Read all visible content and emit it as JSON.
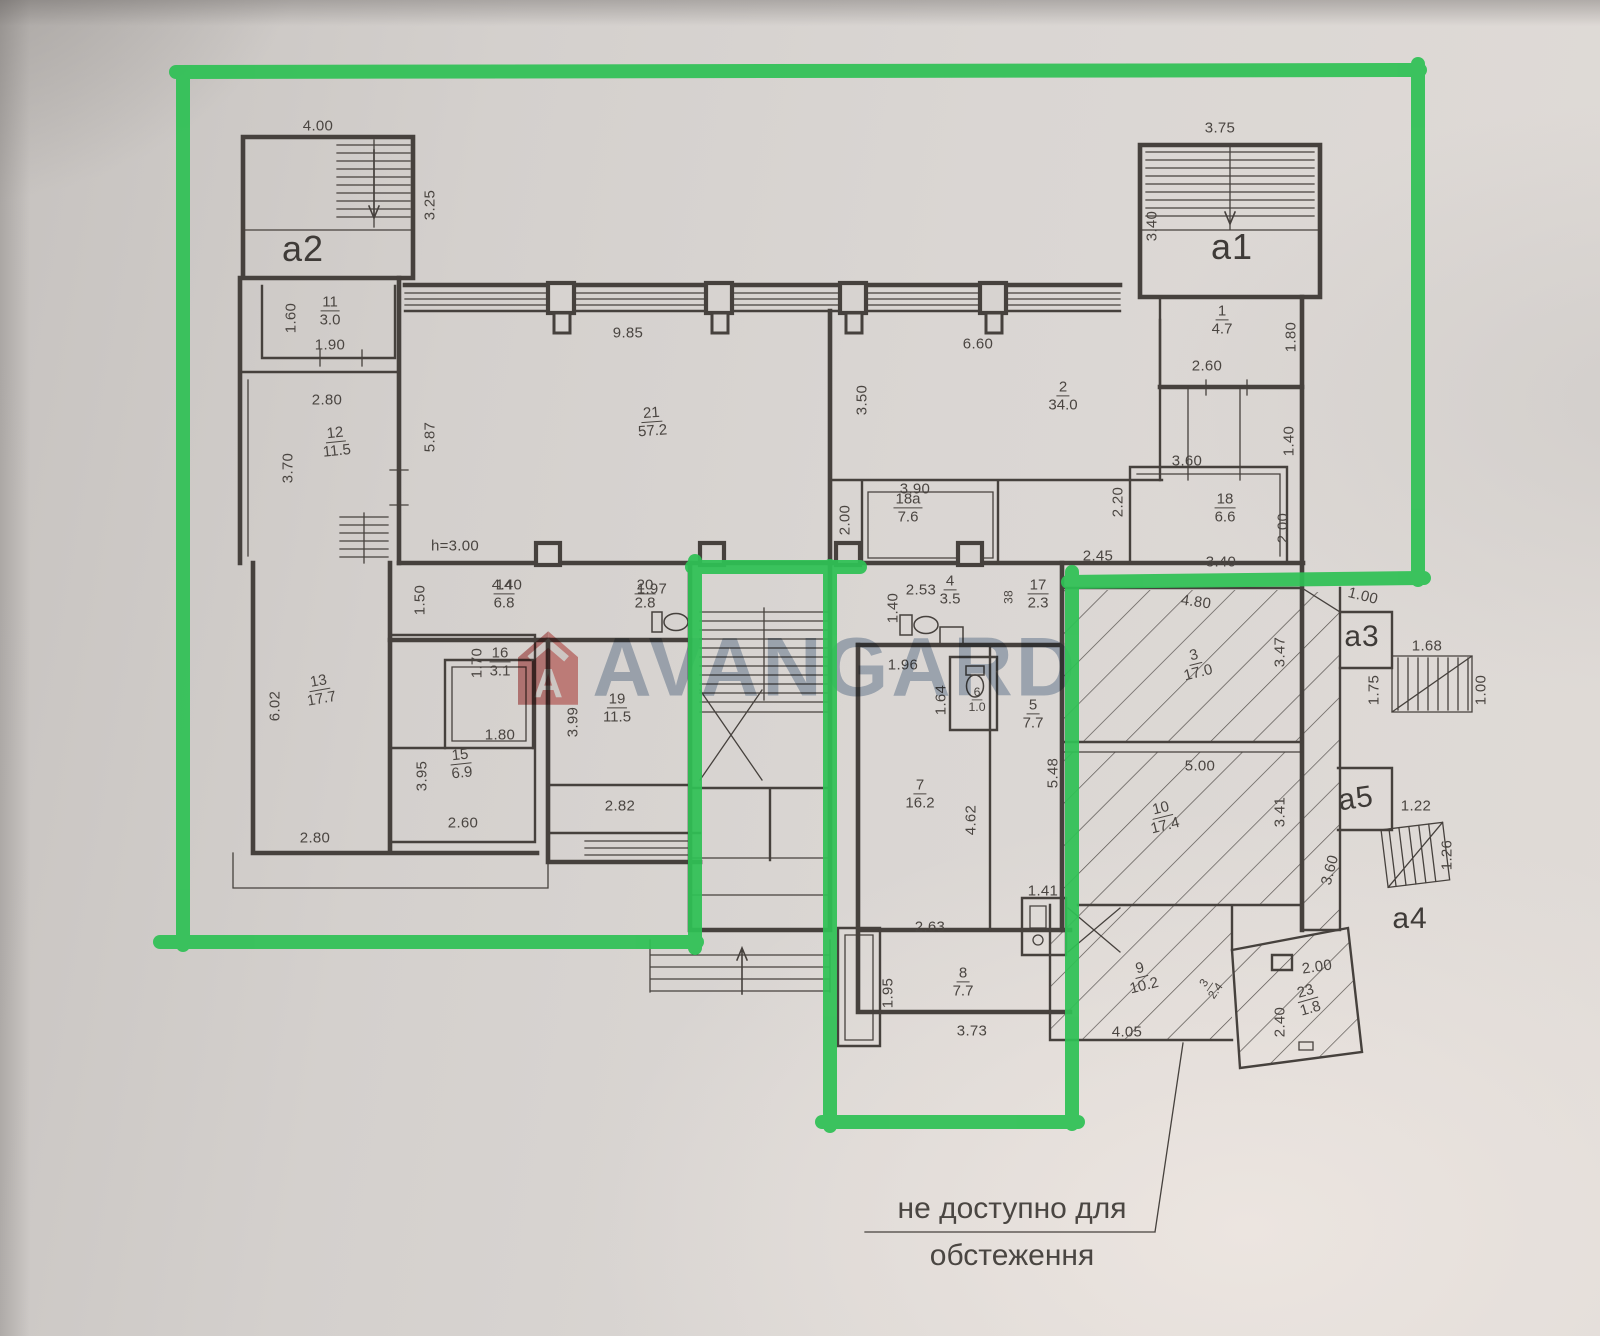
{
  "colors": {
    "annotation_green": "#2fc155",
    "paper": "#d8d4d1",
    "ink": "#44403c",
    "watermark_blue": "#64809f",
    "watermark_red": "#c8504e"
  },
  "watermark": {
    "brand": "AVANGARD",
    "logo_letter": "A"
  },
  "note": {
    "line1": "не доступно для",
    "line2": "обстеження"
  },
  "plan": {
    "block_labels": [
      {
        "text": "a2",
        "x": 303,
        "y": 249,
        "size": 36
      },
      {
        "text": "a1",
        "x": 1232,
        "y": 247,
        "size": 36
      },
      {
        "text": "a3",
        "x": 1362,
        "y": 637,
        "size": 30
      },
      {
        "text": "a5",
        "x": 1356,
        "y": 799,
        "size": 30,
        "rot": -8
      },
      {
        "text": "a4",
        "x": 1410,
        "y": 919,
        "size": 30
      }
    ],
    "room_labels": [
      {
        "num": "11",
        "area": "3.0",
        "x": 330,
        "y": 311
      },
      {
        "num": "12",
        "area": "11.5",
        "x": 336,
        "y": 442,
        "rot": -6
      },
      {
        "num": "21",
        "area": "57.2",
        "x": 652,
        "y": 422,
        "rot": -4
      },
      {
        "num": "2",
        "area": "34.0",
        "x": 1063,
        "y": 396
      },
      {
        "num": "1",
        "area": "4.7",
        "x": 1222,
        "y": 320
      },
      {
        "num": "18a",
        "area": "7.6",
        "x": 908,
        "y": 508
      },
      {
        "num": "18",
        "area": "6.6",
        "x": 1225,
        "y": 508
      },
      {
        "num": "14",
        "area": "6.8",
        "x": 504,
        "y": 594
      },
      {
        "num": "20",
        "area": "2.8",
        "x": 645,
        "y": 594
      },
      {
        "num": "4",
        "area": "3.5",
        "x": 950,
        "y": 590
      },
      {
        "num": "17",
        "area": "2.3",
        "x": 1038,
        "y": 594
      },
      {
        "num": "13",
        "area": "17.7",
        "x": 320,
        "y": 690,
        "rot": -10
      },
      {
        "num": "16",
        "area": "3.1",
        "x": 500,
        "y": 662
      },
      {
        "num": "15",
        "area": "6.9",
        "x": 461,
        "y": 764,
        "rot": -6
      },
      {
        "num": "19",
        "area": "11.5",
        "x": 617,
        "y": 708
      },
      {
        "num": "6",
        "area": "1.0",
        "x": 977,
        "y": 700,
        "scale": 0.82
      },
      {
        "num": "5",
        "area": "7.7",
        "x": 1033,
        "y": 714
      },
      {
        "num": "3",
        "area": "17.0",
        "x": 1196,
        "y": 664,
        "rot": -14
      },
      {
        "num": "7",
        "area": "16.2",
        "x": 920,
        "y": 794
      },
      {
        "num": "10",
        "area": "17.4",
        "x": 1163,
        "y": 817,
        "rot": -14
      },
      {
        "num": "8",
        "area": "7.7",
        "x": 963,
        "y": 982
      },
      {
        "num": "9",
        "area": "10.2",
        "x": 1142,
        "y": 977,
        "rot": -14
      },
      {
        "num": "23",
        "area": "1.8",
        "x": 1308,
        "y": 1000,
        "rot": -16
      },
      {
        "num": "3",
        "area": "2.4",
        "x": 1210,
        "y": 987,
        "rot": -55,
        "scale": 0.78
      }
    ],
    "dim_labels": [
      {
        "text": "4.00",
        "x": 318,
        "y": 126
      },
      {
        "text": "3.75",
        "x": 1220,
        "y": 128
      },
      {
        "text": "3.25",
        "x": 430,
        "y": 205,
        "v": true
      },
      {
        "text": "3.40",
        "x": 1152,
        "y": 226,
        "v": true
      },
      {
        "text": "1.60",
        "x": 291,
        "y": 318,
        "v": true
      },
      {
        "text": "1.90",
        "x": 330,
        "y": 345
      },
      {
        "text": "9.85",
        "x": 628,
        "y": 333
      },
      {
        "text": "6.60",
        "x": 978,
        "y": 344
      },
      {
        "text": "1.80",
        "x": 1291,
        "y": 337,
        "v": true
      },
      {
        "text": "2.60",
        "x": 1207,
        "y": 366
      },
      {
        "text": "2.80",
        "x": 327,
        "y": 400
      },
      {
        "text": "3.50",
        "x": 862,
        "y": 400,
        "v": true
      },
      {
        "text": "5.87",
        "x": 430,
        "y": 437,
        "v": true
      },
      {
        "text": "3.70",
        "x": 288,
        "y": 468,
        "v": true
      },
      {
        "text": "1.40",
        "x": 1289,
        "y": 441,
        "v": true
      },
      {
        "text": "3.90",
        "x": 915,
        "y": 489
      },
      {
        "text": "3.60",
        "x": 1187,
        "y": 461
      },
      {
        "text": "2.00",
        "x": 845,
        "y": 520,
        "v": true
      },
      {
        "text": "2.20",
        "x": 1118,
        "y": 502,
        "v": true
      },
      {
        "text": "2.00",
        "x": 1283,
        "y": 528,
        "v": true
      },
      {
        "text": "h=3.00",
        "x": 455,
        "y": 546
      },
      {
        "text": "2.45",
        "x": 1098,
        "y": 556
      },
      {
        "text": "3.40",
        "x": 1221,
        "y": 562
      },
      {
        "text": "4.40",
        "x": 507,
        "y": 585
      },
      {
        "text": "1.97",
        "x": 652,
        "y": 589
      },
      {
        "text": "2.53",
        "x": 921,
        "y": 590
      },
      {
        "text": "1.50",
        "x": 420,
        "y": 600,
        "v": true
      },
      {
        "text": "1.40",
        "x": 893,
        "y": 608,
        "v": true
      },
      {
        "text": "38",
        "x": 1009,
        "y": 597,
        "v": true,
        "scale": 0.8
      },
      {
        "text": "1.00",
        "x": 1363,
        "y": 596,
        "rot": 14
      },
      {
        "text": "4.80",
        "x": 1196,
        "y": 602,
        "rot": 8
      },
      {
        "text": "1.68",
        "x": 1427,
        "y": 646
      },
      {
        "text": "1.70",
        "x": 477,
        "y": 663,
        "v": true
      },
      {
        "text": "3.47",
        "x": 1280,
        "y": 652,
        "v": true
      },
      {
        "text": "1.64",
        "x": 941,
        "y": 700,
        "v": true
      },
      {
        "text": "1.96",
        "x": 903,
        "y": 665
      },
      {
        "text": "1.75",
        "x": 1374,
        "y": 690,
        "v": true
      },
      {
        "text": "1.00",
        "x": 1481,
        "y": 690,
        "v": true
      },
      {
        "text": "6.02",
        "x": 275,
        "y": 706,
        "v": true
      },
      {
        "text": "3.99",
        "x": 573,
        "y": 722,
        "v": true
      },
      {
        "text": "1.80",
        "x": 500,
        "y": 735
      },
      {
        "text": "5.48",
        "x": 1053,
        "y": 773,
        "v": true
      },
      {
        "text": "5.00",
        "x": 1200,
        "y": 766
      },
      {
        "text": "3.95",
        "x": 422,
        "y": 776,
        "v": true
      },
      {
        "text": "1.22",
        "x": 1416,
        "y": 806
      },
      {
        "text": "3.41",
        "x": 1280,
        "y": 812,
        "v": true
      },
      {
        "text": "4.62",
        "x": 971,
        "y": 820,
        "v": true
      },
      {
        "text": "2.82",
        "x": 620,
        "y": 806
      },
      {
        "text": "2.60",
        "x": 463,
        "y": 823
      },
      {
        "text": "2.80",
        "x": 315,
        "y": 838
      },
      {
        "text": "1.26",
        "x": 1447,
        "y": 855,
        "v": true
      },
      {
        "text": "3.60",
        "x": 1330,
        "y": 870,
        "v": true,
        "rot": -75
      },
      {
        "text": "1.41",
        "x": 1043,
        "y": 891
      },
      {
        "text": "2.63",
        "x": 930,
        "y": 927
      },
      {
        "text": "2.00",
        "x": 1317,
        "y": 967,
        "rot": -8
      },
      {
        "text": "1.95",
        "x": 888,
        "y": 993,
        "v": true
      },
      {
        "text": "2.40",
        "x": 1280,
        "y": 1022,
        "v": true
      },
      {
        "text": "3.73",
        "x": 972,
        "y": 1031
      },
      {
        "text": "4.05",
        "x": 1127,
        "y": 1032
      }
    ]
  }
}
